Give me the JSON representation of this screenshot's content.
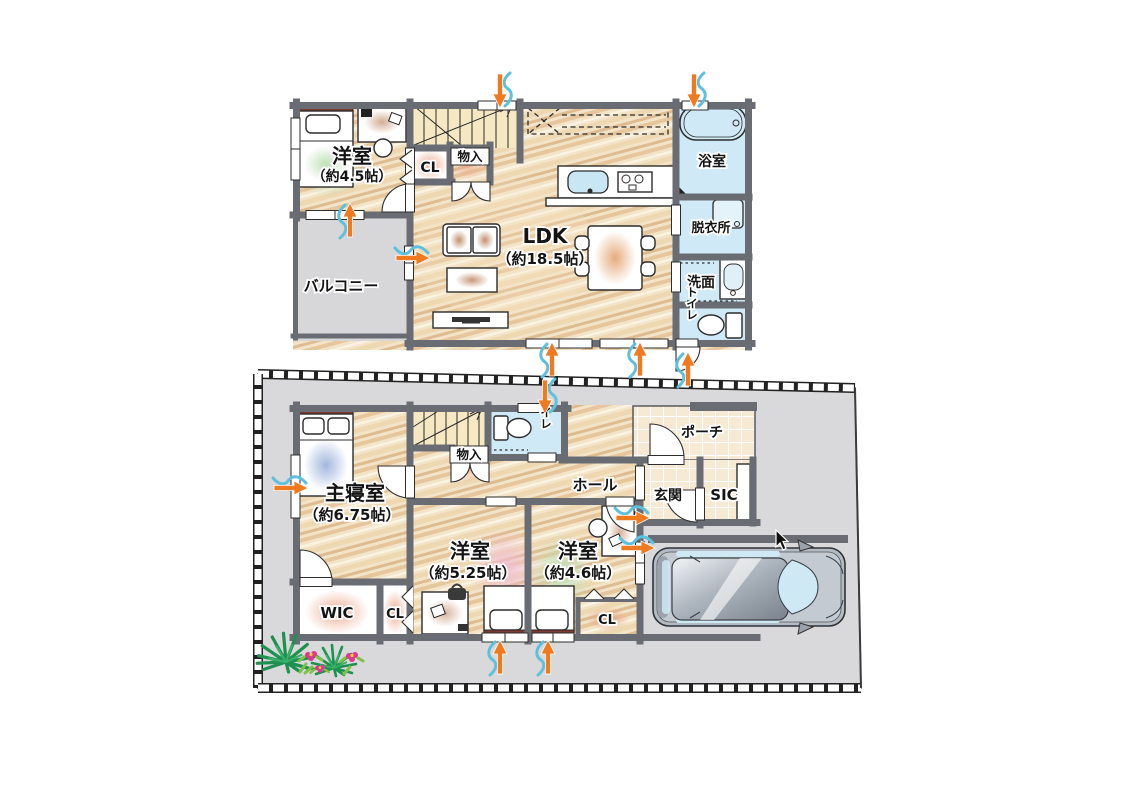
{
  "floor2": {
    "rooms": {
      "yoshitsu45": {
        "name": "洋室",
        "size": "（約4.5帖）"
      },
      "balcony": {
        "name": "バルコニー"
      },
      "closet": {
        "name": "CL"
      },
      "monoire": {
        "name": "物入"
      },
      "ldk": {
        "name": "LDK",
        "size": "（約18.5帖）"
      },
      "bathroom": {
        "name": "浴室"
      },
      "dressing": {
        "name": "脱衣所"
      },
      "washroom": {
        "name": "洗面"
      },
      "toilet": {
        "name": "トイレ"
      }
    }
  },
  "floor1": {
    "rooms": {
      "master": {
        "name": "主寝室",
        "size": "（約6.75帖）"
      },
      "monoire": {
        "name": "物入"
      },
      "toilet": {
        "name": "トイレ"
      },
      "hall": {
        "name": "ホール"
      },
      "porch": {
        "name": "ポーチ"
      },
      "entrance": {
        "name": "玄関"
      },
      "sic": {
        "name": "SIC"
      },
      "yoshitsu525": {
        "name": "洋室",
        "size": "（約5.25帖）"
      },
      "yoshitsu46": {
        "name": "洋室",
        "size": "（約4.6帖）"
      },
      "wic": {
        "name": "WIC"
      },
      "closet1": {
        "name": "CL"
      },
      "closet2": {
        "name": "CL"
      }
    }
  },
  "colors": {
    "wall": "#696d73",
    "wood_base": "#f3e4c8",
    "wet_room": "#cfeaf6",
    "tile_base": "#f7ead4",
    "balcony": "#d7d7d9",
    "lot": "#d9d9db",
    "vent_orange": "#f07a20",
    "vent_blue": "#5fc0de",
    "glow_pink": "#eba489",
    "headboard": "#7c3a30"
  }
}
